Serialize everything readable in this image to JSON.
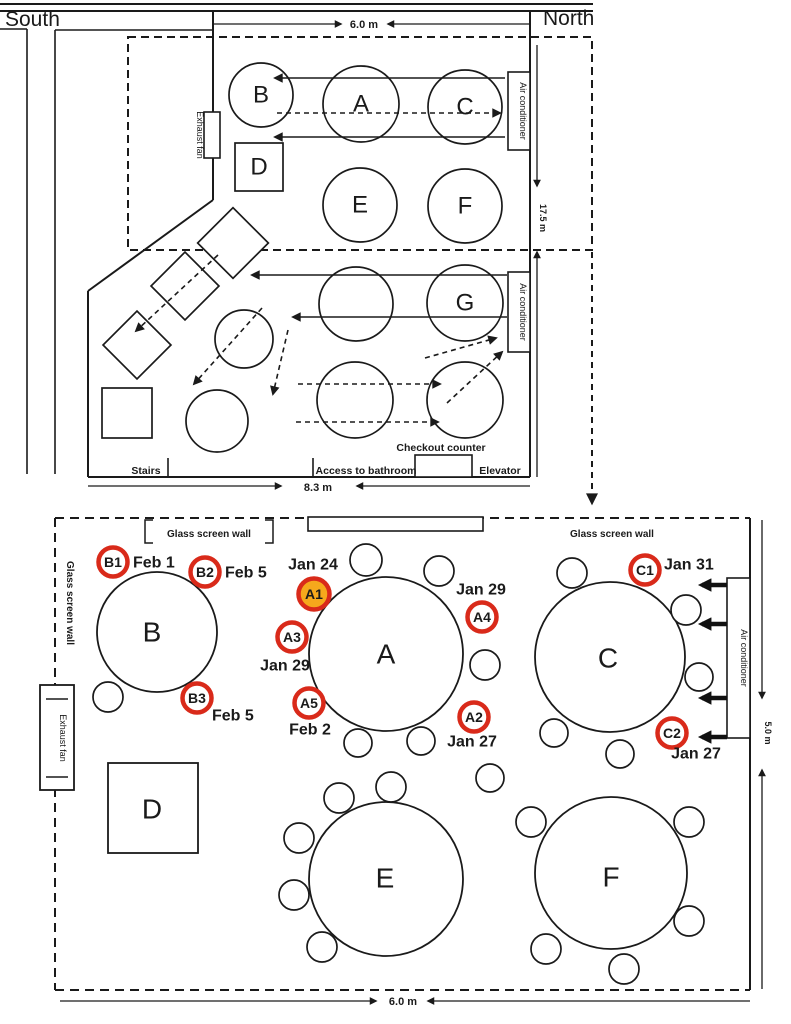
{
  "colors": {
    "red": "#d92a1a",
    "yellow": "#f6a81c",
    "ink": "#1a1a1a"
  },
  "compass": {
    "south": "South",
    "north": "North"
  },
  "overview": {
    "dim_top": "6.0 m",
    "dim_right": "17.5 m",
    "dim_bottom": "8.3 m",
    "exhaust_fan": "Exhaust fan",
    "ac_upper": "Air conditioner",
    "ac_lower": "Air conditioner",
    "stairs": "Stairs",
    "bathroom": "Access to bathroom",
    "checkout": "Checkout counter",
    "elevator": "Elevator",
    "tables": {
      "a": "A",
      "b": "B",
      "c": "C",
      "d": "D",
      "e": "E",
      "f": "F",
      "g": "G"
    }
  },
  "detail": {
    "dim_bottom": "6.0 m",
    "dim_right": "5.0 m",
    "glass_top_left": "Glass screen wall",
    "glass_top_right": "Glass screen wall",
    "glass_left": "Glass screen wall",
    "exhaust_fan": "Exhaust fan",
    "ac": "Air conditioner",
    "tables": {
      "a": "A",
      "b": "B",
      "c": "C",
      "d": "D",
      "e": "E",
      "f": "F"
    },
    "patients": {
      "a1": {
        "id": "A1",
        "date": "Jan 24"
      },
      "a2": {
        "id": "A2",
        "date": "Jan 27"
      },
      "a3": {
        "id": "A3",
        "date": "Jan 29"
      },
      "a4": {
        "id": "A4",
        "date": "Jan 29"
      },
      "a5": {
        "id": "A5",
        "date": "Feb 2"
      },
      "b1": {
        "id": "B1",
        "date": "Feb 1"
      },
      "b2": {
        "id": "B2",
        "date": "Feb 5"
      },
      "b3": {
        "id": "B3",
        "date": "Feb 5"
      },
      "c1": {
        "id": "C1",
        "date": "Jan 31"
      },
      "c2": {
        "id": "C2",
        "date": "Jan 27"
      }
    }
  }
}
